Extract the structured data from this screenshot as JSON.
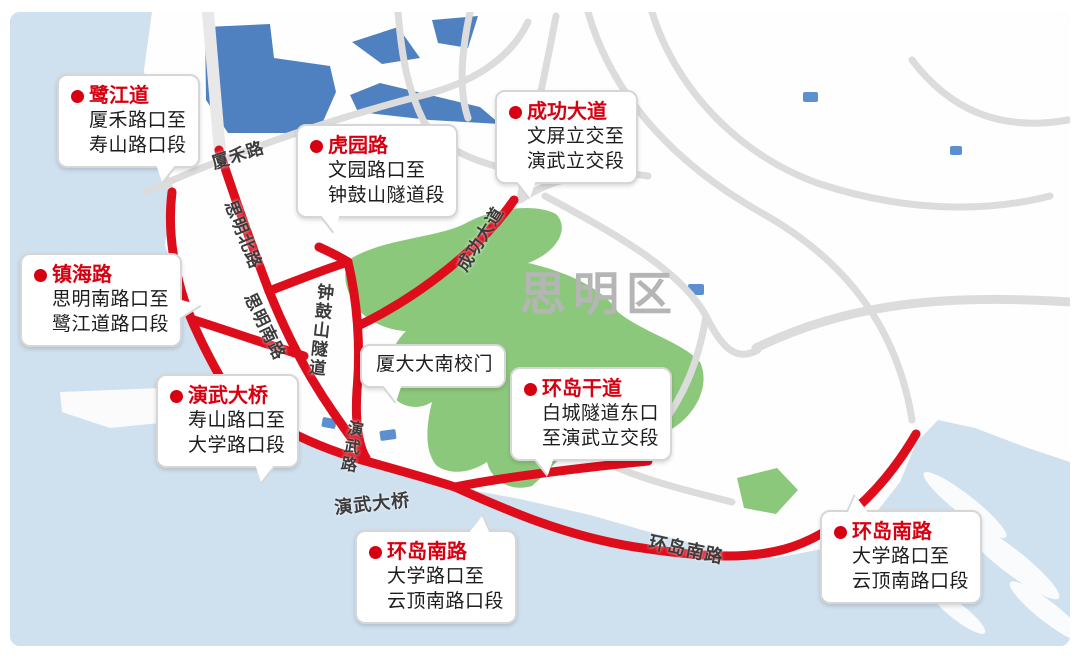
{
  "map": {
    "district_label": "思明区",
    "colors": {
      "water": "#cfe0ee",
      "land": "#fefefe",
      "lake": "#4f81c0",
      "park": "#8cc87c",
      "road_gray": "#dcdcdc",
      "road_red": "#dd0d1c",
      "callout_accent": "#d60011",
      "district_text": "#b5b5b5"
    },
    "road_labels": [
      {
        "id": "label-xiahe-road",
        "text": "厦禾路",
        "x": 208,
        "y": 150,
        "rot": -18,
        "size": 17,
        "vertical": false
      },
      {
        "id": "label-siming-north-road",
        "text": "思明北路",
        "x": 243,
        "y": 196,
        "rot": 68,
        "size": 17,
        "vertical": false
      },
      {
        "id": "label-lujiang-road",
        "text": "鹭江道",
        "x": 160,
        "y": 282,
        "rot": 12,
        "size": 16,
        "vertical": true
      },
      {
        "id": "label-siming-south-road",
        "text": "思明南路",
        "x": 262,
        "y": 288,
        "rot": 64,
        "size": 17,
        "vertical": false
      },
      {
        "id": "label-zhonggushan-tunnel",
        "text": "钟鼓山隧道",
        "x": 312,
        "y": 283,
        "rot": 6,
        "size": 17,
        "vertical": true
      },
      {
        "id": "label-chenggong-avenue",
        "text": "成功大道",
        "x": 449,
        "y": 262,
        "rot": -58,
        "size": 17,
        "vertical": false
      },
      {
        "id": "label-yanwu-road",
        "text": "演武路",
        "x": 342,
        "y": 420,
        "rot": 10,
        "size": 16,
        "vertical": true
      },
      {
        "id": "label-yanwu-bridge",
        "text": "演武大桥",
        "x": 333,
        "y": 494,
        "rot": -6,
        "size": 18,
        "vertical": false
      },
      {
        "id": "label-huandao-south-road",
        "text": "环岛南路",
        "x": 652,
        "y": 528,
        "rot": 12,
        "size": 18,
        "vertical": false
      }
    ],
    "callouts": [
      {
        "id": "callout-lujiangdao",
        "title": "鹭江道",
        "lines": [
          "厦禾路口至",
          "寿山路口段"
        ],
        "x": 57,
        "y": 74,
        "pointer": "br"
      },
      {
        "id": "callout-huyuanlu",
        "title": "虎园路",
        "lines": [
          "文园路口至",
          "钟鼓山隧道段"
        ],
        "x": 296,
        "y": 124,
        "pointer": "bl"
      },
      {
        "id": "callout-chenggongdadao",
        "title": "成功大道",
        "lines": [
          "文屏立交至",
          "演武立交段"
        ],
        "x": 495,
        "y": 90,
        "pointer": "bl"
      },
      {
        "id": "callout-zhenhailu",
        "title": "镇海路",
        "lines": [
          "思明南路口至",
          "鹭江道路口段"
        ],
        "x": 20,
        "y": 253,
        "pointer": "r"
      },
      {
        "id": "callout-yanwudaqiao",
        "title": "演武大桥",
        "lines": [
          "寿山路口至",
          "大学路口段"
        ],
        "x": 156,
        "y": 374,
        "pointer": "br"
      },
      {
        "id": "callout-xiada-gate",
        "title": "",
        "lines": [
          "厦大大南校门"
        ],
        "x": 360,
        "y": 344,
        "pointer": "bl"
      },
      {
        "id": "callout-huandao-gandao",
        "title": "环岛干道",
        "lines": [
          "白城隧道东口",
          "至演武立交段"
        ],
        "x": 510,
        "y": 367,
        "pointer": "bl"
      },
      {
        "id": "callout-huandao-nanlu-mid",
        "title": "环岛南路",
        "lines": [
          "大学路口至",
          "云顶南路口段"
        ],
        "x": 355,
        "y": 530,
        "pointer": "tr"
      },
      {
        "id": "callout-huandao-nanlu-right",
        "title": "环岛南路",
        "lines": [
          "大学路口至",
          "云顶南路口段"
        ],
        "x": 820,
        "y": 510,
        "pointer": "tl"
      }
    ]
  }
}
